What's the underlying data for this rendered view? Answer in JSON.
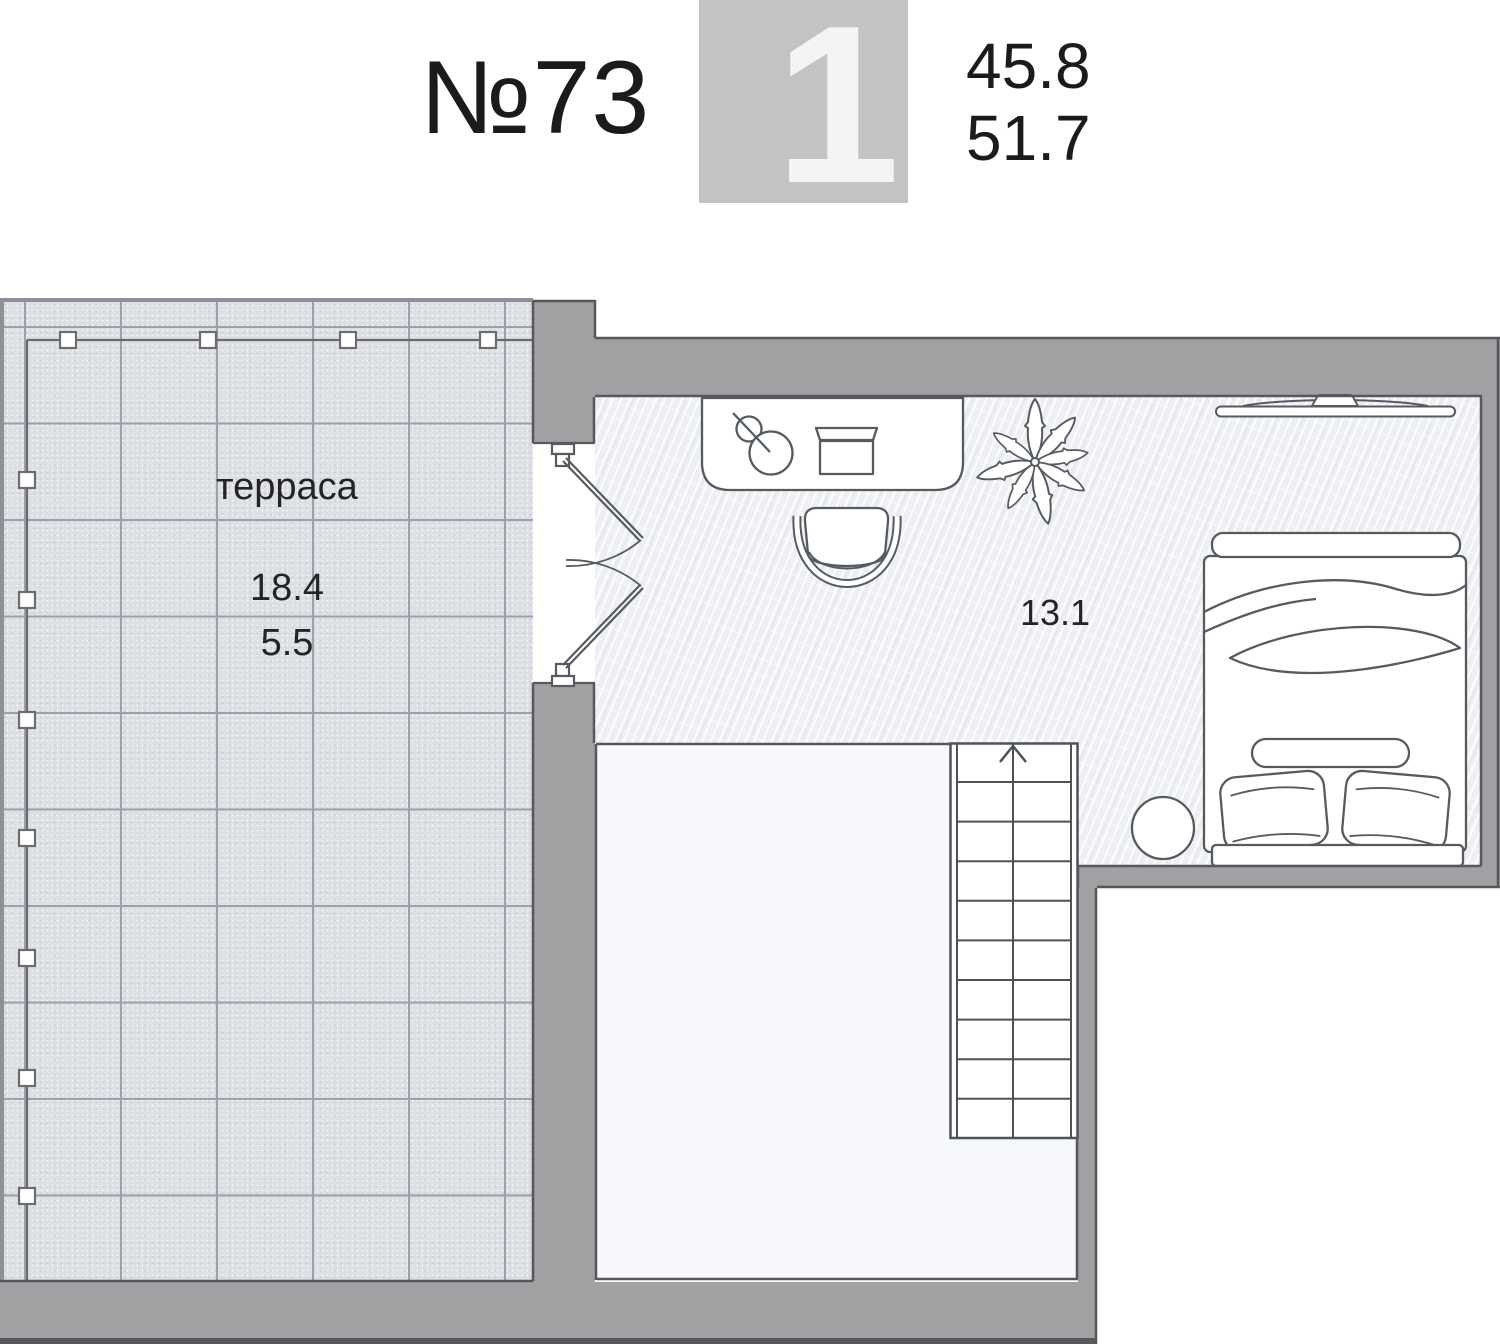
{
  "header": {
    "unit_number": "№73",
    "rooms_badge": "1",
    "area_main": "45.8",
    "area_total": "51.7"
  },
  "plan": {
    "terrace": {
      "label": "терраса",
      "area": "18.4",
      "area_reduced": "5.5"
    },
    "room": {
      "area": "13.1"
    },
    "stairs_direction": "up"
  },
  "colors": {
    "wall": "#a1a1a3",
    "outline": "#58585c",
    "line": "#565b60",
    "tile": "#dcdfe3",
    "tile_grid": "#9aa1ab",
    "floor": "#edeff3",
    "void": "#f6f8fc",
    "badge_bg": "#c3c3c6",
    "badge_digit": "#f4f4f6",
    "text": "#1b1b1d",
    "railing": "#6b6b70"
  }
}
